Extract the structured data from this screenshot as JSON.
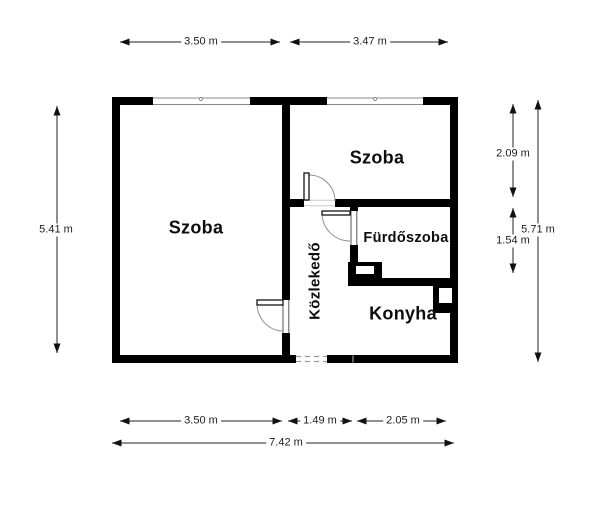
{
  "rooms": {
    "szoba_left": {
      "label": "Szoba"
    },
    "szoba_right": {
      "label": "Szoba"
    },
    "furdoszoba": {
      "label": "Fürdőszoba"
    },
    "kozlekedo": {
      "label": "Közlekedő"
    },
    "konyha": {
      "label": "Konyha"
    }
  },
  "dimensions": {
    "top_left_width": "3.50 m",
    "top_right_width": "3.47 m",
    "left_total_height": "5.41 m",
    "right_szoba_height": "2.09 m",
    "right_furdoszoba_height": "1.54 m",
    "right_total_height": "5.71 m",
    "bottom_szoba_width": "3.50 m",
    "bottom_kozlekedo_width": "1.49 m",
    "bottom_konyha_width": "2.05 m",
    "bottom_total_width": "7.42 m"
  },
  "colors": {
    "wall": "#000000",
    "background": "#ffffff",
    "dimension_line": "#222222",
    "door_arc": "#909090",
    "window_line": "#8a8a8a"
  }
}
